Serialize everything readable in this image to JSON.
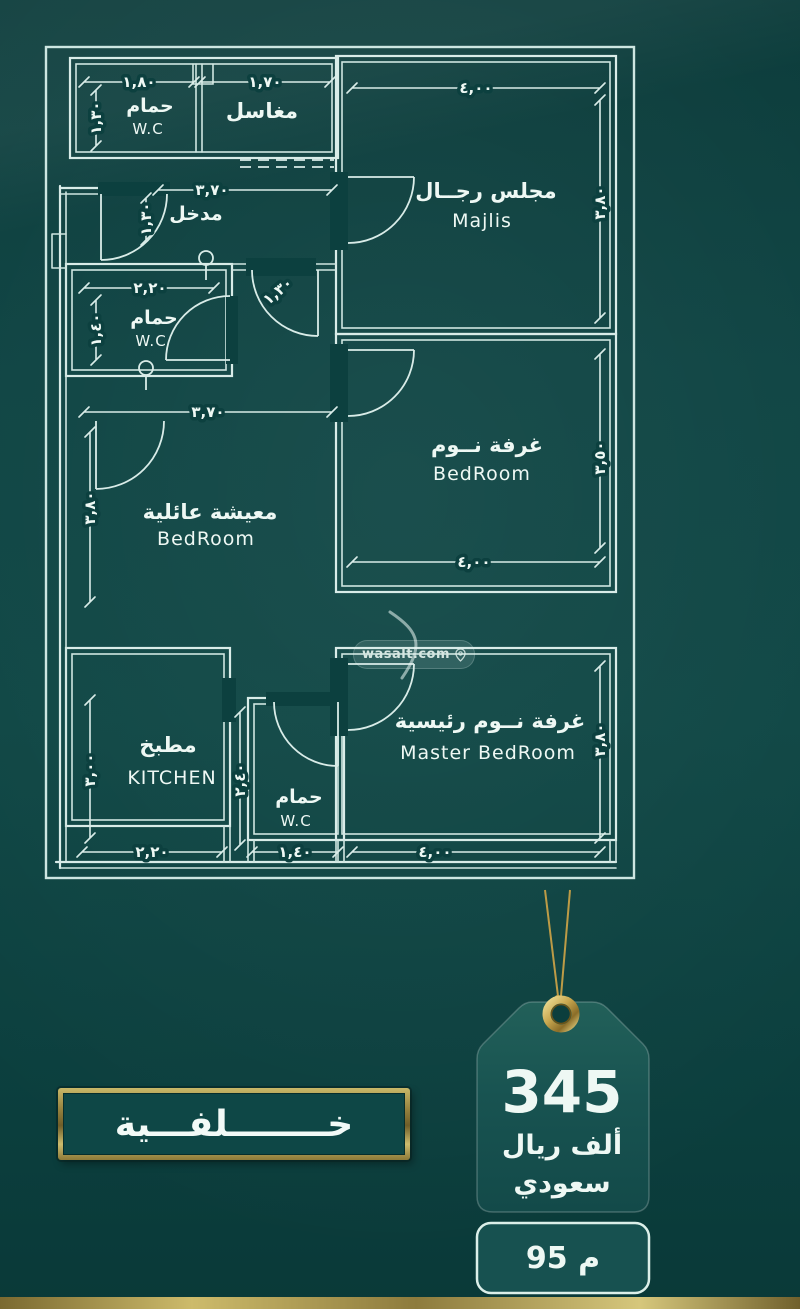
{
  "plan": {
    "rooms": {
      "wc_top": {
        "ar": "حمام",
        "en": "W.C"
      },
      "basins": {
        "ar": "مغاسل"
      },
      "entry": {
        "ar": "مدخل"
      },
      "majlis": {
        "ar": "مجلس رجــال",
        "en": "Majlis"
      },
      "wc_mid": {
        "ar": "حمام",
        "en": "W.C"
      },
      "bedroom": {
        "ar": "غرفة نــوم",
        "en": "BedRoom"
      },
      "living": {
        "ar": "معيشة عائلية",
        "en": "BedRoom"
      },
      "kitchen": {
        "ar": "مطبخ",
        "en": "KITCHEN"
      },
      "wc_bottom": {
        "ar": "حمام",
        "en": "W.C"
      },
      "master": {
        "ar": "غرفة نــوم رئيسية",
        "en": "Master BedRoom"
      }
    },
    "dims": {
      "wc_top_w": "١,٨٠",
      "basins_w": "١,٧٠",
      "wc_top_h": "١,٣٠",
      "entry_w": "٣,٧٠",
      "entry_h": "١,٣٠",
      "majlis_w": "٤,٠٠",
      "majlis_h": "٣,٨٠",
      "wc_mid_w": "٢,٢٠",
      "wc_mid_h": "١,٤٠",
      "hall_door_w": "١,٣٠",
      "hall_w": "٣,٧٠",
      "bedroom_w": "٤,٠٠",
      "bedroom_h": "٣,٥٠",
      "living_h": "٣,٨٠",
      "kitchen_w": "٢,٢٠",
      "kitchen_h": "٣,٠٠",
      "wc_bottom_w": "١,٤٠",
      "wc_bottom_h": "٢,٤٠",
      "master_w": "٤,٠٠",
      "master_h": "٣,٨٠"
    }
  },
  "watermark": {
    "text": "wasalt.com"
  },
  "price_tag": {
    "amount": "345",
    "currency_line1": "ألف ريال",
    "currency_line2": "سعودي",
    "area": "95 م"
  },
  "side_label": {
    "text": "خــــــــلفـــية"
  },
  "colors": {
    "background": "#0c403f",
    "line": "#d9ece8",
    "gold": "#c9ae57",
    "tag_fill": "#1b5755"
  }
}
